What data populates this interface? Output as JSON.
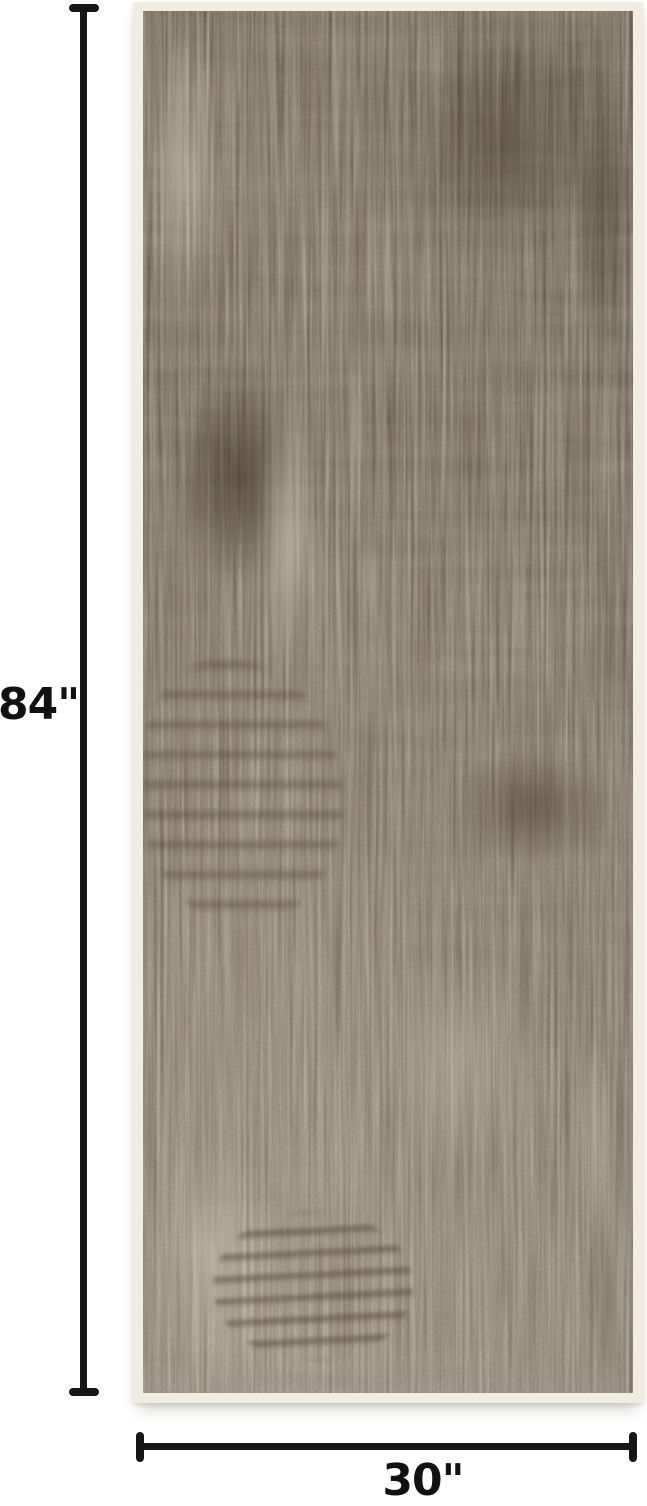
{
  "product_image": {
    "description": "Brown distressed abstract runner rug shown flat with dimension lines"
  },
  "dimensions": {
    "height": {
      "label": "84\""
    },
    "width": {
      "label": "30\""
    }
  },
  "colors": {
    "background": "#ffffff",
    "dimension_line": "#161616",
    "label_text": "#111111",
    "rug_border": "#f0ecdf",
    "rug_top": "#695d4c",
    "rug_mid": "#837766",
    "rug_bottom": "#a79c8b",
    "rug_dark_accent": "#4f4335",
    "rug_light_accent": "#c3baa9"
  }
}
